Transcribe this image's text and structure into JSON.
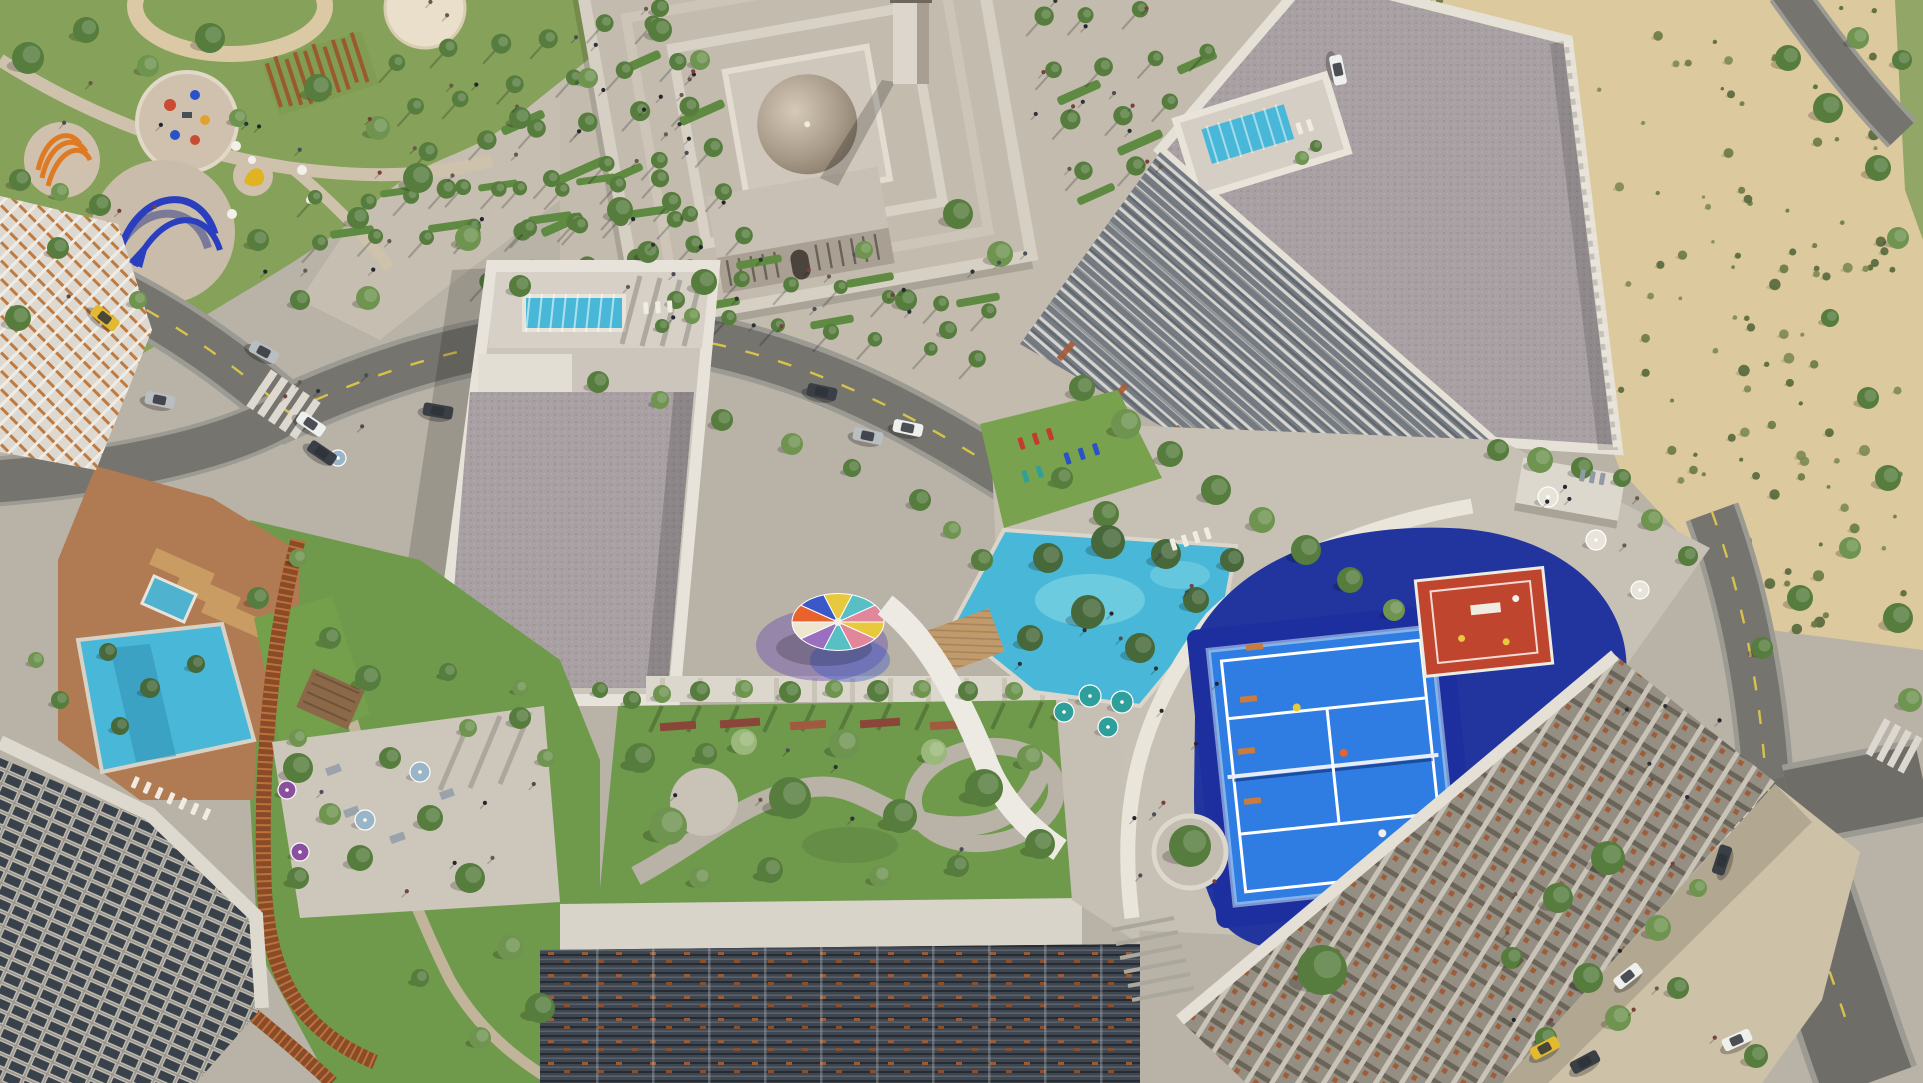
{
  "document": {
    "kind": "aerial-architectural-rendering",
    "width": 1923,
    "height": 1083
  },
  "palette": {
    "base": "#b9b3a7",
    "plaza": "#c6beb0",
    "pathTan": "#d2c2a4",
    "parkGrass": "#86a159",
    "parkGrassDark": "#6d8a47",
    "roadCore": "#75746e",
    "roadCase": "#9b9a93",
    "laneYellow": "#d8c34a",
    "zebra": "#ddd9d0",
    "sand": "#dcc99e",
    "shrubA": "#6a7a44",
    "shrubB": "#55683a",
    "shrubC": "#7c8a50",
    "concrete": "#ccc5bb",
    "parapet": "#e8e3da",
    "gravel": "#a8a0a2",
    "coreBlock": "#e3ded4",
    "pool": "#49b8d8",
    "poolLight": "#7fd6e4",
    "poolDeck": "#d6d0c6",
    "lawn": "#79a24e",
    "gardenGrass": "#6f9a4c",
    "louverBase": "#3f4650",
    "finBase": "#757b82",
    "latticeBase": "#8d867c",
    "rust": "#9a5c38",
    "orangeLattice": "#bf7a40",
    "windowBase": "#98938a",
    "windowGlass": "#39414b",
    "domeLight": "#d6c9b8",
    "domeDark": "#857867",
    "mosqueWall": "#d6cfc3",
    "navy": "#22349e",
    "padelBlue": "#2f7de2",
    "courtRed": "#c0452e",
    "lineWhite": "#ffffff",
    "corten": "#8a4b28",
    "cortenLight": "#c87c3e",
    "terracottaGround": "#b07a52",
    "wood": "#c99c63",
    "pavilion": "#8a6848",
    "treeTones": [
      "#46683a",
      "#567c3e",
      "#6f9450",
      "#9ab87a"
    ],
    "canopyWedges": [
      "#e8c93e",
      "#e2869c",
      "#58bfc4",
      "#9a6fc0",
      "#efe6cf",
      "#e8632c",
      "#3a58c8",
      "#e8c93e",
      "#58bfc4",
      "#e2869c"
    ],
    "sculptureOrange": "#e07a22",
    "sculptureBlue": "#2a3fc0",
    "sculptureYellow": "#e0b320",
    "taxi": "#e3b92e",
    "white": "#eef0ee",
    "dark": "#3a3f46",
    "silver": "#b9bec2",
    "teal": "#2f9f9b",
    "blue": "#9ab4c8",
    "purple": "#8a4f9e",
    "whiteU": "#e8e4da",
    "grayseat": "#8f9aa3",
    "red": "#c23b2e",
    "blueL": "#2a52c8",
    "tealL": "#2f9f9b",
    "whiteL": "#f0ece2"
  },
  "scene": {
    "trees": [
      [
        28,
        58,
        16,
        1
      ],
      [
        86,
        30,
        13,
        1
      ],
      [
        148,
        66,
        11,
        2
      ],
      [
        210,
        38,
        15,
        1
      ],
      [
        318,
        88,
        14,
        1
      ],
      [
        378,
        128,
        12,
        2
      ],
      [
        58,
        248,
        11,
        1
      ],
      [
        18,
        318,
        13,
        1
      ],
      [
        138,
        300,
        9,
        2
      ],
      [
        258,
        240,
        11,
        1
      ],
      [
        418,
        178,
        15,
        1
      ],
      [
        468,
        238,
        13,
        2
      ],
      [
        520,
        118,
        11,
        1
      ],
      [
        588,
        78,
        10,
        2
      ],
      [
        238,
        118,
        9,
        2
      ],
      [
        358,
        218,
        11,
        1
      ],
      [
        300,
        300,
        10,
        1
      ],
      [
        368,
        298,
        12,
        2
      ],
      [
        520,
        286,
        11,
        1
      ],
      [
        620,
        210,
        13,
        1
      ],
      [
        20,
        180,
        11,
        1
      ],
      [
        60,
        192,
        9,
        2
      ],
      [
        100,
        205,
        11,
        1
      ],
      [
        660,
        30,
        12,
        1
      ],
      [
        700,
        60,
        10,
        2
      ],
      [
        598,
        382,
        11,
        1
      ],
      [
        660,
        400,
        9,
        2
      ],
      [
        722,
        420,
        11,
        1
      ],
      [
        792,
        444,
        11,
        2
      ],
      [
        852,
        468,
        9,
        1
      ],
      [
        920,
        500,
        11,
        1
      ],
      [
        952,
        530,
        9,
        2
      ],
      [
        982,
        560,
        11,
        1
      ],
      [
        648,
        252,
        11,
        1
      ],
      [
        704,
        282,
        13,
        1
      ],
      [
        958,
        214,
        15,
        1
      ],
      [
        1000,
        254,
        13,
        2
      ],
      [
        906,
        300,
        11,
        1
      ],
      [
        948,
        330,
        9,
        1
      ],
      [
        864,
        250,
        9,
        2
      ],
      [
        660,
        8,
        9,
        1
      ],
      [
        690,
        214,
        8,
        1
      ],
      [
        1082,
        388,
        13,
        1
      ],
      [
        1126,
        424,
        15,
        2
      ],
      [
        1170,
        454,
        13,
        1
      ],
      [
        1216,
        490,
        15,
        1
      ],
      [
        1262,
        520,
        13,
        2
      ],
      [
        1306,
        550,
        15,
        1
      ],
      [
        1350,
        580,
        13,
        1
      ],
      [
        1394,
        610,
        11,
        2
      ],
      [
        1062,
        478,
        11,
        1
      ],
      [
        1106,
        514,
        13,
        1
      ],
      [
        1498,
        450,
        11,
        1
      ],
      [
        1540,
        460,
        13,
        2
      ],
      [
        1582,
        468,
        11,
        1
      ],
      [
        1622,
        478,
        9,
        1
      ],
      [
        1652,
        520,
        11,
        2
      ],
      [
        1688,
        556,
        10,
        1
      ],
      [
        640,
        758,
        15,
        1
      ],
      [
        668,
        826,
        19,
        2
      ],
      [
        706,
        754,
        11,
        1
      ],
      [
        744,
        742,
        13,
        3
      ],
      [
        790,
        798,
        21,
        1
      ],
      [
        844,
        744,
        15,
        2
      ],
      [
        900,
        816,
        17,
        1
      ],
      [
        934,
        752,
        13,
        3
      ],
      [
        984,
        788,
        19,
        1
      ],
      [
        1030,
        758,
        13,
        2
      ],
      [
        1040,
        844,
        15,
        1
      ],
      [
        700,
        878,
        11,
        2
      ],
      [
        770,
        870,
        13,
        1
      ],
      [
        880,
        876,
        11,
        2
      ],
      [
        958,
        866,
        11,
        1
      ],
      [
        632,
        700,
        9,
        1
      ],
      [
        662,
        694,
        9,
        2
      ],
      [
        700,
        691,
        10,
        1
      ],
      [
        744,
        689,
        9,
        2
      ],
      [
        790,
        692,
        11,
        1
      ],
      [
        834,
        689,
        9,
        2
      ],
      [
        878,
        691,
        11,
        1
      ],
      [
        922,
        689,
        9,
        2
      ],
      [
        968,
        691,
        10,
        1
      ],
      [
        1014,
        691,
        9,
        2
      ],
      [
        298,
        768,
        15,
        1
      ],
      [
        330,
        814,
        11,
        2
      ],
      [
        360,
        858,
        13,
        1
      ],
      [
        298,
        878,
        11,
        1
      ],
      [
        468,
        728,
        9,
        2
      ],
      [
        520,
        718,
        11,
        1
      ],
      [
        546,
        758,
        9,
        2
      ],
      [
        258,
        598,
        11,
        1
      ],
      [
        298,
        558,
        9,
        2
      ],
      [
        330,
        638,
        11,
        1
      ],
      [
        368,
        678,
        13,
        1
      ],
      [
        298,
        738,
        9,
        2
      ],
      [
        390,
        758,
        11,
        1
      ],
      [
        430,
        818,
        13,
        1
      ],
      [
        470,
        878,
        15,
        1
      ],
      [
        510,
        948,
        13,
        2
      ],
      [
        540,
        1008,
        15,
        1
      ],
      [
        480,
        1038,
        11,
        2
      ],
      [
        420,
        978,
        9,
        1
      ],
      [
        60,
        700,
        9,
        1
      ],
      [
        36,
        660,
        8,
        2
      ],
      [
        1558,
        898,
        15,
        1
      ],
      [
        1608,
        858,
        17,
        1
      ],
      [
        1658,
        928,
        13,
        2
      ],
      [
        1588,
        978,
        15,
        1
      ],
      [
        1546,
        1038,
        11,
        1
      ],
      [
        1618,
        1018,
        13,
        2
      ],
      [
        1678,
        988,
        11,
        1
      ],
      [
        1698,
        888,
        9,
        2
      ],
      [
        1512,
        958,
        11,
        1
      ],
      [
        1756,
        1056,
        12,
        1
      ],
      [
        1788,
        58,
        13,
        1
      ],
      [
        1828,
        108,
        15,
        1
      ],
      [
        1858,
        38,
        11,
        2
      ],
      [
        1878,
        168,
        13,
        1
      ],
      [
        1898,
        238,
        11,
        2
      ],
      [
        1830,
        318,
        9,
        1
      ],
      [
        1868,
        398,
        11,
        1
      ],
      [
        1888,
        478,
        13,
        1
      ],
      [
        1850,
        548,
        11,
        2
      ],
      [
        1800,
        598,
        13,
        1
      ],
      [
        1762,
        648,
        11,
        1
      ],
      [
        1898,
        618,
        15,
        1
      ],
      [
        1910,
        700,
        12,
        2
      ],
      [
        1902,
        60,
        10,
        1
      ],
      [
        1048,
        558,
        15,
        0
      ],
      [
        1108,
        542,
        17,
        0
      ],
      [
        1166,
        554,
        15,
        0
      ],
      [
        1088,
        612,
        17,
        0
      ],
      [
        1030,
        638,
        13,
        0
      ],
      [
        1140,
        648,
        15,
        0
      ],
      [
        1196,
        600,
        13,
        0
      ],
      [
        1232,
        560,
        12,
        0
      ],
      [
        1302,
        158,
        7,
        2
      ],
      [
        1316,
        146,
        6,
        1
      ],
      [
        676,
        300,
        9,
        1
      ],
      [
        692,
        316,
        8,
        2
      ],
      [
        662,
        326,
        7,
        1
      ],
      [
        448,
        672,
        9,
        1
      ],
      [
        520,
        688,
        8,
        2
      ],
      [
        600,
        690,
        8,
        1
      ],
      [
        108,
        652,
        9,
        0
      ],
      [
        150,
        688,
        10,
        0
      ],
      [
        196,
        664,
        9,
        0
      ],
      [
        120,
        726,
        9,
        0
      ],
      [
        1190,
        846,
        21,
        1
      ],
      [
        1322,
        970,
        25,
        1
      ]
    ],
    "palm_bands": [
      {
        "x": 395,
        "y": 60,
        "cols": 6,
        "dx": 52,
        "dy": -8,
        "rows": 6,
        "rx": 18,
        "ry": 44,
        "r": 9,
        "skipC1": false
      },
      {
        "x": 1040,
        "y": 18,
        "cols": 5,
        "dx": 50,
        "dy": -6,
        "rows": 4,
        "rx": 16,
        "ry": 50,
        "r": 9,
        "skipC1": true
      },
      {
        "x": 640,
        "y": 262,
        "cols": 8,
        "dx": 50,
        "dy": 7,
        "rows": 2,
        "rx": -14,
        "ry": 46,
        "r": 8,
        "skipC1": false
      },
      {
        "x": 315,
        "y": 200,
        "cols": 8,
        "dx": 50,
        "dy": -3,
        "rows": 2,
        "rx": 10,
        "ry": 40,
        "r": 8,
        "skipC1": false
      }
    ],
    "hedges": [
      [
        500,
        118,
        46,
        9,
        -24
      ],
      [
        556,
        166,
        50,
        9,
        -24
      ],
      [
        618,
        58,
        44,
        9,
        -24
      ],
      [
        678,
        108,
        48,
        9,
        -24
      ],
      [
        540,
        220,
        44,
        9,
        -24
      ],
      [
        604,
        170,
        40,
        8,
        -24
      ],
      [
        1056,
        88,
        46,
        9,
        -24
      ],
      [
        1116,
        138,
        48,
        9,
        -24
      ],
      [
        1176,
        58,
        42,
        9,
        -24
      ],
      [
        1076,
        190,
        40,
        8,
        -24
      ],
      [
        736,
        258,
        46,
        8,
        -10
      ],
      [
        846,
        276,
        48,
        8,
        -10
      ],
      [
        956,
        296,
        44,
        8,
        -10
      ],
      [
        700,
        300,
        40,
        8,
        -10
      ],
      [
        810,
        318,
        44,
        8,
        -10
      ],
      [
        330,
        228,
        44,
        8,
        -8
      ],
      [
        428,
        222,
        46,
        8,
        -8
      ],
      [
        528,
        214,
        44,
        8,
        -8
      ],
      [
        626,
        208,
        44,
        8,
        -8
      ],
      [
        380,
        188,
        40,
        7,
        -8
      ],
      [
        478,
        182,
        40,
        7,
        -8
      ],
      [
        576,
        176,
        40,
        7,
        -8
      ]
    ],
    "shrub_field": {
      "count": 130,
      "seed": 11
    },
    "people_areas": [
      [
        430,
        0,
        300,
        230,
        26
      ],
      [
        1032,
        0,
        130,
        170,
        13
      ],
      [
        620,
        235,
        420,
        95,
        18
      ],
      [
        60,
        80,
        360,
        220,
        16
      ],
      [
        1112,
        600,
        110,
        320,
        9
      ],
      [
        1500,
        850,
        220,
        190,
        10
      ],
      [
        640,
        745,
        380,
        140,
        6
      ],
      [
        292,
        742,
        250,
        150,
        6
      ],
      [
        1502,
        462,
        170,
        90,
        5
      ],
      [
        1002,
        540,
        220,
        160,
        7
      ],
      [
        284,
        372,
        120,
        70,
        5
      ],
      [
        1620,
        700,
        160,
        120,
        6
      ]
    ],
    "cars": [
      [
        105,
        318,
        38,
        "taxi"
      ],
      [
        160,
        400,
        12,
        "silver"
      ],
      [
        311,
        424,
        34,
        "white"
      ],
      [
        322,
        453,
        34,
        "dark"
      ],
      [
        438,
        411,
        10,
        "dark"
      ],
      [
        264,
        352,
        28,
        "silver"
      ],
      [
        822,
        392,
        12,
        "dark"
      ],
      [
        868,
        436,
        12,
        "silver"
      ],
      [
        908,
        428,
        12,
        "white"
      ],
      [
        1338,
        70,
        78,
        "white"
      ],
      [
        1628,
        976,
        -38,
        "white"
      ],
      [
        1722,
        860,
        -72,
        "dark"
      ],
      [
        1545,
        1048,
        -28,
        "taxi"
      ],
      [
        1585,
        1062,
        -28,
        "dark"
      ],
      [
        1737,
        1040,
        -24,
        "white"
      ]
    ],
    "umbrellas": [
      [
        1090,
        696,
        11,
        "teal"
      ],
      [
        1122,
        702,
        11,
        "teal"
      ],
      [
        1064,
        712,
        10,
        "teal"
      ],
      [
        1108,
        727,
        10,
        "teal"
      ],
      [
        365,
        820,
        10,
        "blue"
      ],
      [
        420,
        772,
        10,
        "blue"
      ],
      [
        1548,
        497,
        10,
        "whiteU"
      ],
      [
        1596,
        540,
        10,
        "whiteU"
      ],
      [
        287,
        790,
        9,
        "purple"
      ],
      [
        300,
        852,
        9,
        "purple"
      ],
      [
        338,
        458,
        8,
        "blue"
      ],
      [
        1640,
        590,
        9,
        "whiteU"
      ]
    ],
    "loungers": [
      [
        1022,
        437,
        -18,
        3,
        15,
        "red"
      ],
      [
        1068,
        452,
        -18,
        3,
        15,
        "blueL"
      ],
      [
        1026,
        470,
        -18,
        2,
        15,
        "tealL"
      ],
      [
        1174,
        538,
        -18,
        4,
        12,
        "whiteL"
      ],
      [
        140,
        778,
        24,
        7,
        13,
        "whiteL"
      ],
      [
        648,
        302,
        -4,
        3,
        12,
        "whiteL"
      ],
      [
        1300,
        122,
        -17,
        2,
        11,
        "whiteL"
      ],
      [
        1586,
        470,
        10,
        3,
        10,
        "grayseat"
      ]
    ]
  }
}
